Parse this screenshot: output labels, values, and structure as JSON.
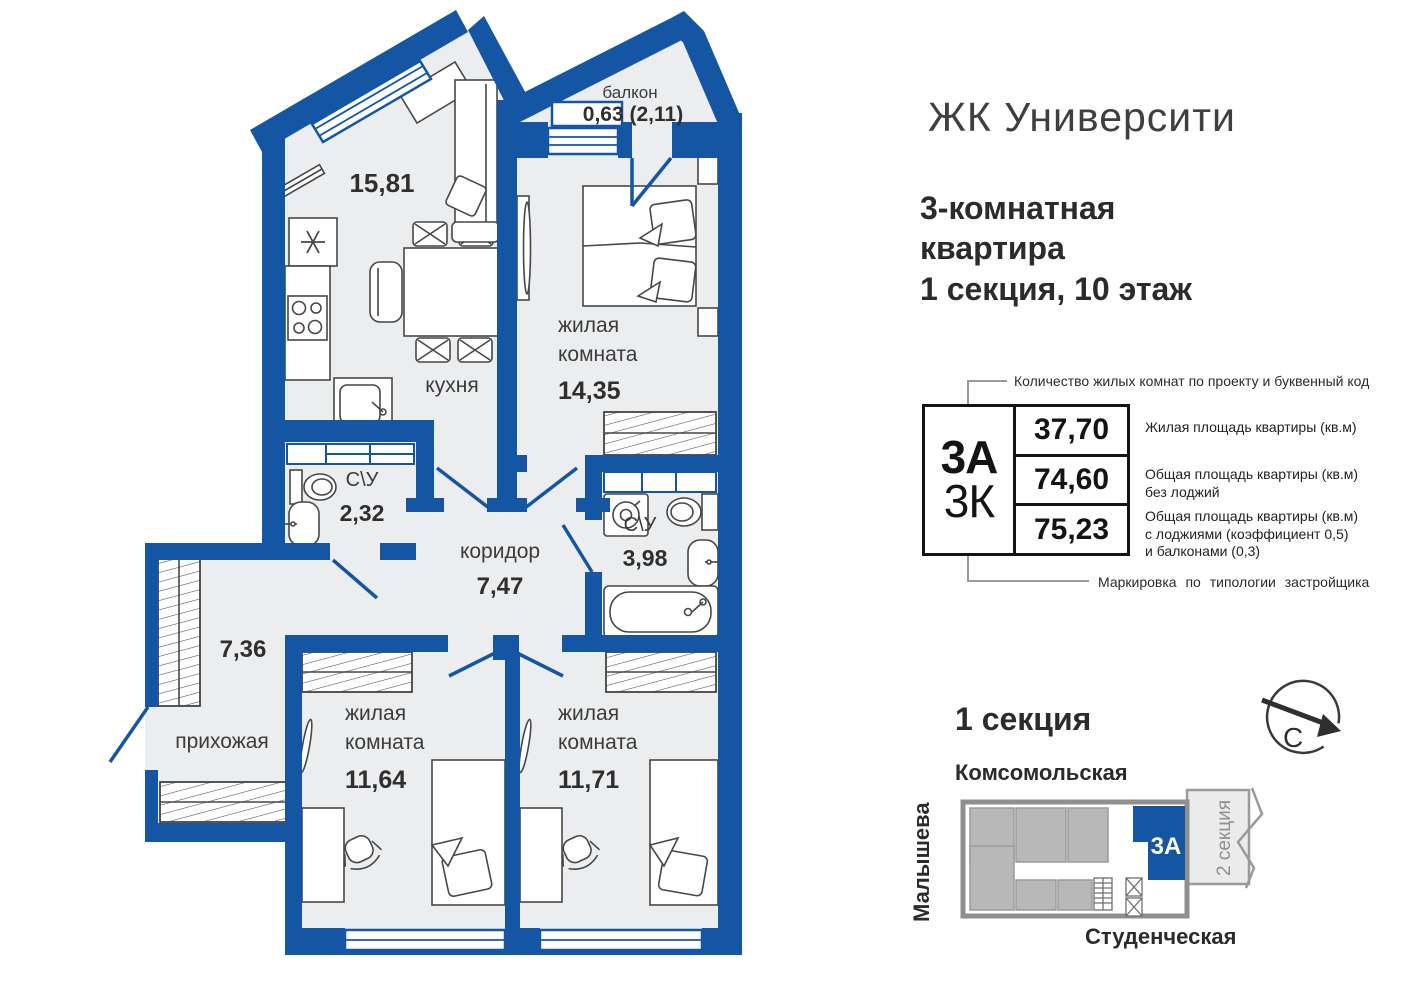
{
  "header": {
    "brand": "ЖК Университи",
    "subtitle1": "3-комнатная",
    "subtitle2": "квартира",
    "subtitle3": "1 секция, 10 этаж"
  },
  "plan": {
    "balcony_label": "балкон",
    "balcony_area": "0,63 (2,11)",
    "kitchen_area": "15,81",
    "kitchen_label": "кухня",
    "bedroom_top_l1": "жилая",
    "bedroom_top_l2": "комната",
    "bedroom_top_area": "14,35",
    "wc_small_label": "С\\У",
    "wc_small_area": "2,32",
    "corridor_label": "коридор",
    "corridor_area": "7,47",
    "wc_big_label": "С\\У",
    "wc_big_area": "3,98",
    "hallway_area": "7,36",
    "hallway_label": "прихожая",
    "bedroom_left_l1": "жилая",
    "bedroom_left_l2": "комната",
    "bedroom_left_area": "11,64",
    "bedroom_right_l1": "жилая",
    "bedroom_right_l2": "комната",
    "bedroom_right_area": "11,71"
  },
  "legend": {
    "top_note": "Количество жилых комнат по проекту и буквенный код",
    "code_main": "3А",
    "code_alt": "3К",
    "value1": "37,70",
    "value2": "74,60",
    "value3": "75,23",
    "desc1_l1": "Жилая площадь квартиры (кв.м)",
    "desc2_l1": "Общая площадь квартиры (кв.м)",
    "desc2_l2": "без лоджий",
    "desc3_l1": "Общая площадь квартиры (кв.м)",
    "desc3_l2": "с лоджиями (коэффициент 0,5)",
    "desc3_l3": "и балконами (0,3)",
    "bottom_note": "Маркировка по типологии застройщика"
  },
  "minimap": {
    "title": "1 секция",
    "street_top": "Комсомольская",
    "street_left": "Малышева",
    "street_bottom": "Студенческая",
    "unit": "3А",
    "section2": "2 секция",
    "compass": "С"
  },
  "colors": {
    "wall_blue": "#1456A4",
    "floor_gray": "#ECEDEF",
    "map_gray": "#B8B8B8",
    "map_light": "#EBEBEB",
    "text_dark": "#2B2B2B"
  }
}
